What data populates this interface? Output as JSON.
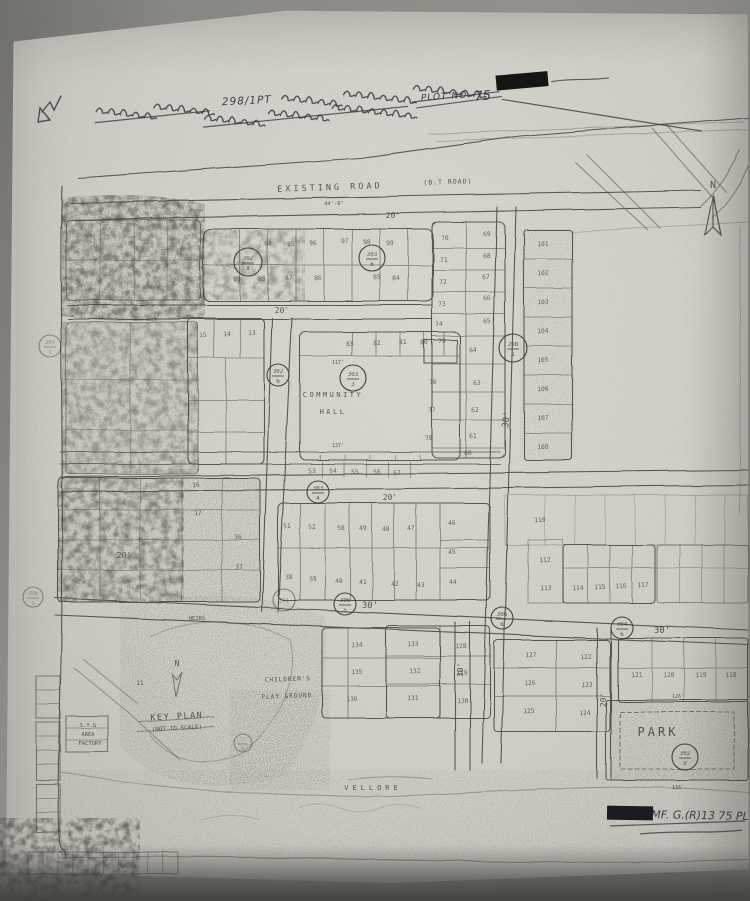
{
  "annotation": {
    "line1_tamil_before": "மனைநாடப்பட்ட நகர்",
    "line1_survey": "298/1PT",
    "line1_tamil_after": "அதன் அருகில் கிடைக்கும் இடம்",
    "line2_tamil": "அதுசுமார் — கிடைக்க எண்ணுடைய",
    "line2_plot_label": "PLOT NO.",
    "line2_plot_number": "75",
    "redaction_present": "redacted-black-mark"
  },
  "footer": {
    "reference": "MF. G.(R)13  75 PL"
  },
  "map": {
    "ink_color": "#45423d",
    "paper_color": "#d2cfc9",
    "highlight_plot_fill": "#22201d",
    "labels": [
      {
        "name": "existing-road-label",
        "t": "EXISTING ROAD",
        "x": 330,
        "y": 190,
        "s": 8.5,
        "ls": 3,
        "r": -2,
        "o": 0.8
      },
      {
        "name": "existing-road-type",
        "t": "(B.T ROAD)",
        "x": 448,
        "y": 184,
        "s": 6.5,
        "ls": 1,
        "r": -2,
        "o": 0.6
      },
      {
        "name": "existing-road-dim",
        "t": "44'-6\"",
        "x": 334,
        "y": 205,
        "s": 5.5,
        "r": -1,
        "o": 0.5
      },
      {
        "name": "road-width-20-top",
        "t": "20'",
        "x": 393,
        "y": 218,
        "s": 8
      },
      {
        "name": "road-width-20-a",
        "t": "20'",
        "x": 282,
        "y": 313,
        "s": 8
      },
      {
        "name": "road-width-20-mid",
        "t": "20'",
        "x": 390,
        "y": 500,
        "s": 8
      },
      {
        "name": "road-width-20-left",
        "t": "20'",
        "x": 124,
        "y": 558,
        "s": 8
      },
      {
        "name": "road-width-30-main",
        "t": "30'",
        "x": 509,
        "y": 420,
        "s": 9,
        "r": -83
      },
      {
        "name": "road-width-30-b",
        "t": "30'",
        "x": 370,
        "y": 608,
        "s": 9
      },
      {
        "name": "road-width-30-c",
        "t": "30'",
        "x": 662,
        "y": 633,
        "s": 9
      },
      {
        "name": "road-width-30-d",
        "t": "30'",
        "x": 463,
        "y": 670,
        "s": 8,
        "r": -88
      },
      {
        "name": "road-width-20-d",
        "t": "20'",
        "x": 606,
        "y": 700,
        "s": 8,
        "r": -88
      },
      {
        "name": "community-hall-line1",
        "t": "COMMUNITY",
        "x": 333,
        "y": 397,
        "s": 7,
        "ls": 2.5
      },
      {
        "name": "community-hall-line2",
        "t": "HALL",
        "x": 333,
        "y": 414,
        "s": 7,
        "ls": 2.5
      },
      {
        "name": "dim-117",
        "t": "117'",
        "x": 338,
        "y": 364,
        "s": 5,
        "o": 0.5
      },
      {
        "name": "dim-137",
        "t": "137'",
        "x": 338,
        "y": 447,
        "s": 5,
        "o": 0.55
      },
      {
        "name": "childrens-playground-line1",
        "t": "CHILDREN'S",
        "x": 288,
        "y": 681,
        "s": 6,
        "ls": 1,
        "r": -2
      },
      {
        "name": "childrens-playground-line2",
        "t": "PLAY GROUND",
        "x": 287,
        "y": 698,
        "s": 6,
        "ls": 1,
        "r": -2
      },
      {
        "name": "park-label",
        "t": "PARK",
        "x": 658,
        "y": 736,
        "s": 12,
        "ls": 3
      },
      {
        "name": "key-plan-label",
        "t": "KEY PLAN",
        "x": 177,
        "y": 719,
        "s": 8.5,
        "ls": 1.5,
        "r": -3
      },
      {
        "name": "not-to-scale-label",
        "t": "(NOT TO SCALE)",
        "x": 177,
        "y": 730,
        "s": 6,
        "r": -3
      },
      {
        "name": "vellore-label",
        "t": "VELLORE",
        "x": 373,
        "y": 790,
        "s": 7,
        "ls": 4,
        "o": 0.5
      },
      {
        "name": "factory-line1",
        "t": "S.Y.G",
        "x": 88,
        "y": 727,
        "s": 5.5,
        "o": 0.7
      },
      {
        "name": "factory-line2",
        "t": "AREA",
        "x": 88,
        "y": 736,
        "s": 5.5,
        "o": 0.7
      },
      {
        "name": "factory-line3",
        "t": "FACTORY",
        "x": 90,
        "y": 745,
        "s": 5.5,
        "o": 0.7
      },
      {
        "name": "north-letter-main",
        "t": "N",
        "x": 713,
        "y": 188,
        "s": 10
      },
      {
        "name": "north-letter-key",
        "t": "N",
        "x": 177,
        "y": 666,
        "s": 8
      },
      {
        "name": "heirs-note",
        "t": "HEIRS",
        "x": 197,
        "y": 620,
        "s": 5.5,
        "o": 0.5,
        "r": -2
      },
      {
        "name": "key-plan-number",
        "t": "11",
        "x": 140,
        "y": 685,
        "s": 6,
        "o": 0.6
      },
      {
        "name": "dim-126",
        "t": "126'",
        "x": 678,
        "y": 698,
        "s": 5,
        "o": 0.5
      },
      {
        "name": "dim-116",
        "t": "116'",
        "x": 678,
        "y": 789,
        "s": 5,
        "o": 0.5
      },
      {
        "name": "annotation-survey-number",
        "t": "298/1PT",
        "x": 247,
        "y": 104,
        "s": 10.5,
        "cls": "hand",
        "r": -3,
        "ls": 1
      },
      {
        "name": "annotation-plot-label",
        "t": "PLOT NO.",
        "x": 446,
        "y": 99,
        "s": 9,
        "cls": "hand",
        "r": -4,
        "ls": 1
      },
      {
        "name": "annotation-plot-number",
        "t": "75",
        "x": 483,
        "y": 100,
        "s": 13,
        "cls": "hand",
        "r": -4
      },
      {
        "name": "footer-reference",
        "t": "MF. G.(R)13  75 PL",
        "x": 700,
        "y": 819,
        "s": 11,
        "cls": "hand",
        "r": 1
      }
    ],
    "survey_circles": [
      {
        "num": "302",
        "den": "8",
        "x": 248,
        "y": 262,
        "rad": 14
      },
      {
        "num": "303",
        "den": "6",
        "x": 372,
        "y": 258,
        "rad": 13
      },
      {
        "num": "298",
        "den": "1",
        "x": 513,
        "y": 348,
        "rad": 14
      },
      {
        "num": "303",
        "den": "3",
        "x": 353,
        "y": 378,
        "rad": 13
      },
      {
        "num": "302",
        "den": "6",
        "x": 278,
        "y": 375,
        "rad": 11
      },
      {
        "num": "305",
        "den": "1",
        "x": 50,
        "y": 346,
        "rad": 11,
        "o": 0.5
      },
      {
        "num": "306",
        "den": "1",
        "x": 33,
        "y": 597,
        "rad": 10,
        "o": 0.5
      },
      {
        "num": "303",
        "den": "4",
        "x": 318,
        "y": 492,
        "rad": 11
      },
      {
        "num": "301",
        "den": "",
        "x": 284,
        "y": 600,
        "rad": 11,
        "o": 0.6
      },
      {
        "num": "306",
        "den": "5",
        "x": 345,
        "y": 604,
        "rad": 11
      },
      {
        "num": "306",
        "den": "6",
        "x": 502,
        "y": 618,
        "rad": 11
      },
      {
        "num": "304",
        "den": "6",
        "x": 622,
        "y": 628,
        "rad": 11
      },
      {
        "num": "302",
        "den": "9",
        "x": 685,
        "y": 757,
        "rad": 13
      },
      {
        "num": "7",
        "den": "B",
        "x": 243,
        "y": 743,
        "rad": 9,
        "o": 0.5
      }
    ],
    "plot_numbers": [
      {
        "n": "94",
        "x": 268,
        "y": 246
      },
      {
        "n": "95",
        "x": 291,
        "y": 246
      },
      {
        "n": "96",
        "x": 313,
        "y": 245
      },
      {
        "n": "97",
        "x": 345,
        "y": 243
      },
      {
        "n": "98",
        "x": 367,
        "y": 244
      },
      {
        "n": "99",
        "x": 390,
        "y": 245
      },
      {
        "n": "89",
        "x": 237,
        "y": 281
      },
      {
        "n": "88",
        "x": 262,
        "y": 281
      },
      {
        "n": "87",
        "x": 289,
        "y": 280
      },
      {
        "n": "86",
        "x": 318,
        "y": 280
      },
      {
        "n": "85",
        "x": 377,
        "y": 279
      },
      {
        "n": "84",
        "x": 396,
        "y": 280
      },
      {
        "n": "70",
        "x": 445,
        "y": 240
      },
      {
        "n": "71",
        "x": 444,
        "y": 262
      },
      {
        "n": "72",
        "x": 443,
        "y": 284
      },
      {
        "n": "73",
        "x": 442,
        "y": 306
      },
      {
        "n": "74",
        "x": 439,
        "y": 326
      },
      {
        "n": "76",
        "x": 433,
        "y": 384
      },
      {
        "n": "77",
        "x": 432,
        "y": 412
      },
      {
        "n": "78",
        "x": 429,
        "y": 440
      },
      {
        "n": "69",
        "x": 487,
        "y": 236
      },
      {
        "n": "68",
        "x": 487,
        "y": 258
      },
      {
        "n": "67",
        "x": 486,
        "y": 279
      },
      {
        "n": "66",
        "x": 487,
        "y": 300
      },
      {
        "n": "65",
        "x": 487,
        "y": 323
      },
      {
        "n": "64",
        "x": 473,
        "y": 352
      },
      {
        "n": "63",
        "x": 477,
        "y": 385
      },
      {
        "n": "62",
        "x": 475,
        "y": 412
      },
      {
        "n": "61",
        "x": 473,
        "y": 438
      },
      {
        "n": "60",
        "x": 468,
        "y": 455
      },
      {
        "n": "101",
        "x": 543,
        "y": 246
      },
      {
        "n": "102",
        "x": 543,
        "y": 275
      },
      {
        "n": "103",
        "x": 543,
        "y": 304
      },
      {
        "n": "104",
        "x": 543,
        "y": 333
      },
      {
        "n": "105",
        "x": 543,
        "y": 362
      },
      {
        "n": "106",
        "x": 543,
        "y": 391
      },
      {
        "n": "107",
        "x": 543,
        "y": 420
      },
      {
        "n": "108",
        "x": 543,
        "y": 449
      },
      {
        "n": "110",
        "x": 540,
        "y": 522
      },
      {
        "n": "112",
        "x": 545,
        "y": 562
      },
      {
        "n": "113",
        "x": 546,
        "y": 590
      },
      {
        "n": "15",
        "x": 203,
        "y": 337
      },
      {
        "n": "14",
        "x": 227,
        "y": 336
      },
      {
        "n": "13",
        "x": 252,
        "y": 335
      },
      {
        "n": "83",
        "x": 350,
        "y": 346
      },
      {
        "n": "82",
        "x": 377,
        "y": 345
      },
      {
        "n": "81",
        "x": 403,
        "y": 344
      },
      {
        "n": "80",
        "x": 424,
        "y": 344
      },
      {
        "n": "79",
        "x": 442,
        "y": 343
      },
      {
        "n": "16",
        "x": 196,
        "y": 487
      },
      {
        "n": "17",
        "x": 198,
        "y": 515
      },
      {
        "n": "36",
        "x": 238,
        "y": 539
      },
      {
        "n": "37",
        "x": 239,
        "y": 569
      },
      {
        "n": "53",
        "x": 312,
        "y": 473
      },
      {
        "n": "54",
        "x": 333,
        "y": 473
      },
      {
        "n": "55",
        "x": 355,
        "y": 474
      },
      {
        "n": "56",
        "x": 377,
        "y": 474
      },
      {
        "n": "57",
        "x": 397,
        "y": 475
      },
      {
        "n": "51",
        "x": 287,
        "y": 528
      },
      {
        "n": "52",
        "x": 312,
        "y": 529
      },
      {
        "n": "50",
        "x": 341,
        "y": 530
      },
      {
        "n": "49",
        "x": 363,
        "y": 530
      },
      {
        "n": "48",
        "x": 386,
        "y": 531
      },
      {
        "n": "47",
        "x": 411,
        "y": 530
      },
      {
        "n": "46",
        "x": 452,
        "y": 525
      },
      {
        "n": "45",
        "x": 452,
        "y": 554
      },
      {
        "n": "44",
        "x": 453,
        "y": 584
      },
      {
        "n": "38",
        "x": 289,
        "y": 579
      },
      {
        "n": "39",
        "x": 313,
        "y": 581
      },
      {
        "n": "40",
        "x": 339,
        "y": 583
      },
      {
        "n": "41",
        "x": 363,
        "y": 584
      },
      {
        "n": "42",
        "x": 395,
        "y": 586
      },
      {
        "n": "43",
        "x": 421,
        "y": 587
      },
      {
        "n": "114",
        "x": 578,
        "y": 590
      },
      {
        "n": "115",
        "x": 600,
        "y": 589
      },
      {
        "n": "116",
        "x": 621,
        "y": 588
      },
      {
        "n": "117",
        "x": 643,
        "y": 587
      },
      {
        "n": "134",
        "x": 357,
        "y": 647
      },
      {
        "n": "135",
        "x": 357,
        "y": 674
      },
      {
        "n": "136",
        "x": 352,
        "y": 701
      },
      {
        "n": "133",
        "x": 413,
        "y": 646
      },
      {
        "n": "128",
        "x": 461,
        "y": 648
      },
      {
        "n": "132",
        "x": 415,
        "y": 673
      },
      {
        "n": "129",
        "x": 462,
        "y": 675
      },
      {
        "n": "131",
        "x": 413,
        "y": 700
      },
      {
        "n": "130",
        "x": 463,
        "y": 703
      },
      {
        "n": "127",
        "x": 531,
        "y": 657
      },
      {
        "n": "122",
        "x": 586,
        "y": 659
      },
      {
        "n": "126",
        "x": 530,
        "y": 685
      },
      {
        "n": "123",
        "x": 587,
        "y": 687
      },
      {
        "n": "125",
        "x": 529,
        "y": 713
      },
      {
        "n": "124",
        "x": 585,
        "y": 715
      },
      {
        "n": "121",
        "x": 637,
        "y": 677
      },
      {
        "n": "120",
        "x": 669,
        "y": 677
      },
      {
        "n": "119",
        "x": 701,
        "y": 677
      },
      {
        "n": "118",
        "x": 731,
        "y": 677
      }
    ]
  }
}
